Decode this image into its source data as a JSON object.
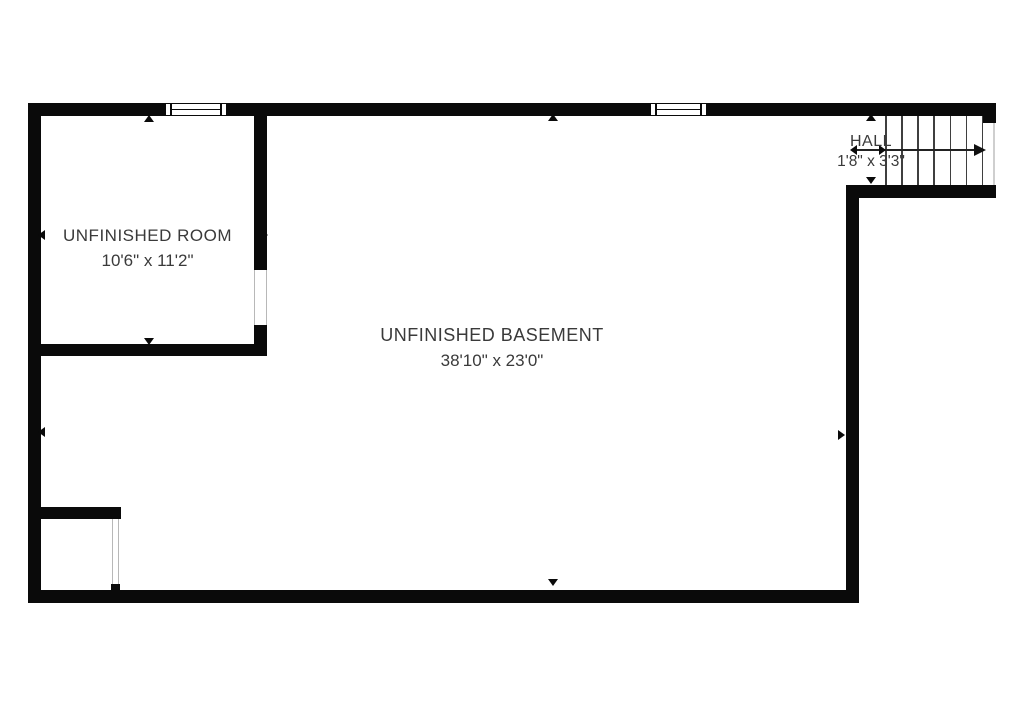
{
  "title": "Basement floor plan",
  "rooms": [
    {
      "id": "unfinished-room",
      "name": "UNFINISHED ROOM",
      "dimensions": "10'6\" x 11'2\""
    },
    {
      "id": "unfinished-basement",
      "name": "UNFINISHED BASEMENT",
      "dimensions": "38'10\" x 23'0\""
    },
    {
      "id": "hall",
      "name": "HALL",
      "dimensions": "1'8\" x 3'3\""
    }
  ],
  "features": {
    "windows": 2,
    "stairs": {
      "treads": 6,
      "direction": "up to the right"
    },
    "door_openings": 3
  },
  "colors": {
    "wall": "#0a0a0a",
    "background": "#ffffff",
    "text": "#3a3a3a",
    "tread_line": "#3f3f3f"
  }
}
